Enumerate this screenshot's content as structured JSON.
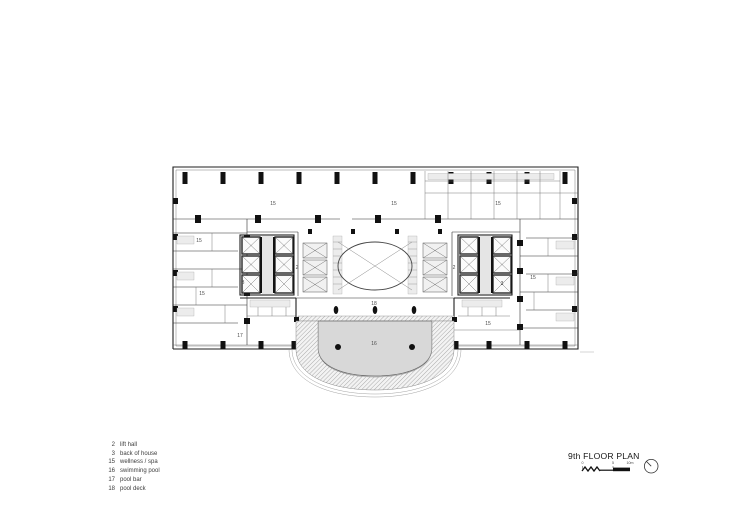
{
  "document": {
    "type": "architectural floor plan drawing",
    "background": "#ffffff"
  },
  "plan": {
    "colors": {
      "line": "#1f1f1f",
      "pool_fill": "#d8d8d8",
      "corridor_fill": "#ececec",
      "hatch": "#8a8a8a"
    },
    "labels": [
      {
        "text": "15",
        "x": 273,
        "y": 205
      },
      {
        "text": "15",
        "x": 394,
        "y": 205
      },
      {
        "text": "15",
        "x": 498,
        "y": 205
      },
      {
        "text": "15",
        "x": 199,
        "y": 242
      },
      {
        "text": "15",
        "x": 202,
        "y": 295
      },
      {
        "text": "2",
        "x": 297,
        "y": 269
      },
      {
        "text": "3",
        "x": 243,
        "y": 284
      },
      {
        "text": "2",
        "x": 454,
        "y": 269
      },
      {
        "text": "3",
        "x": 502,
        "y": 285
      },
      {
        "text": "15",
        "x": 533,
        "y": 279
      },
      {
        "text": "15",
        "x": 488,
        "y": 325
      },
      {
        "text": "17",
        "x": 240,
        "y": 337
      },
      {
        "text": "18",
        "x": 374,
        "y": 305
      },
      {
        "text": "16",
        "x": 374,
        "y": 345
      }
    ]
  },
  "legend": {
    "items": [
      {
        "num": "2",
        "label": "lift hall"
      },
      {
        "num": "3",
        "label": "back of house"
      },
      {
        "num": "15",
        "label": "wellness / spa"
      },
      {
        "num": "16",
        "label": "swimming pool"
      },
      {
        "num": "17",
        "label": "pool bar"
      },
      {
        "num": "18",
        "label": "pool deck"
      }
    ]
  },
  "titleblock": {
    "title": "9th FLOOR PLAN",
    "scale": {
      "ticks": [
        "0",
        "5",
        "10m"
      ]
    },
    "north_icon": "north-arrow-icon"
  }
}
